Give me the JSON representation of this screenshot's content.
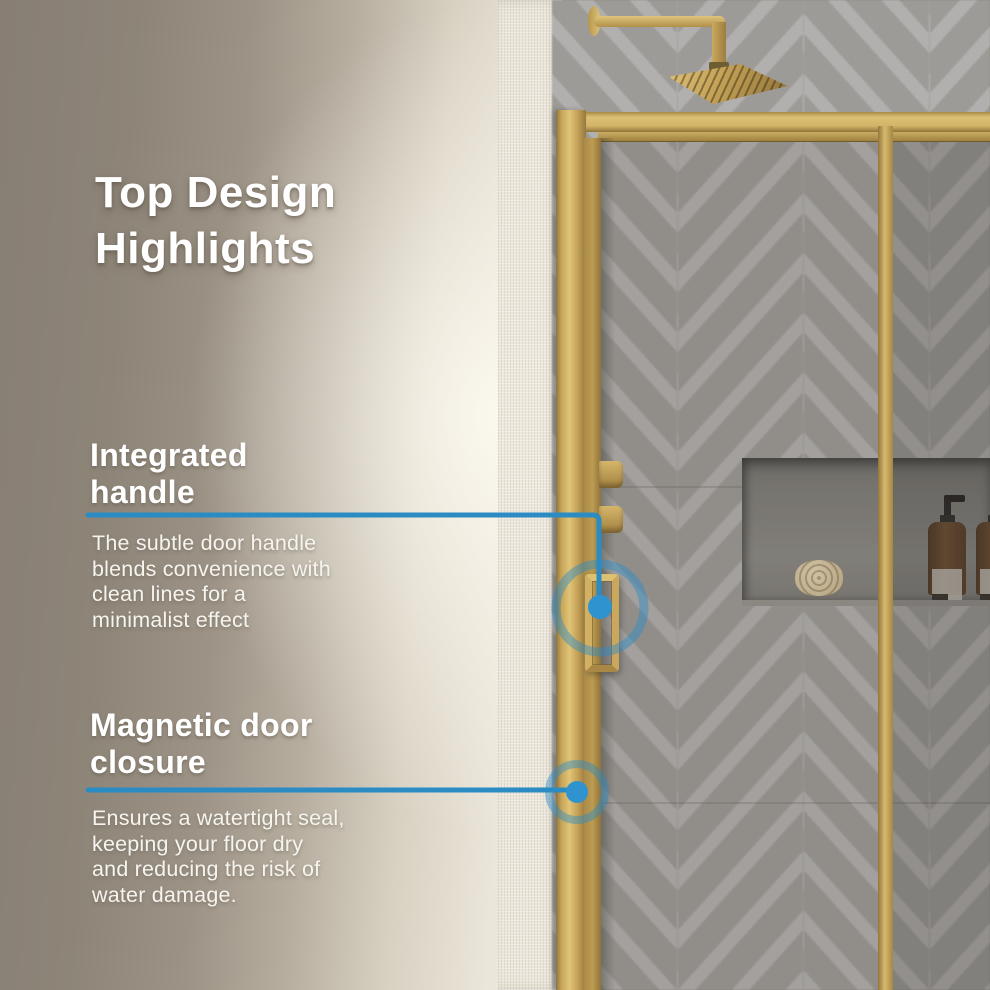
{
  "title": "Top Design\nHighlights",
  "features": [
    {
      "heading": "Integrated\nhandle",
      "body": "The subtle door handle\nblends convenience with\nclean lines for a\nminimalist effect"
    },
    {
      "heading": "Magnetic door\nclosure",
      "body": "Ensures a watertight seal,\nkeeping your floor dry\nand reducing the risk of\nwater damage."
    }
  ],
  "colors": {
    "accent_blue": "#2b8cc4",
    "accent_blue_ring": "rgba(43,140,200,0.45)",
    "frame_gold": "#c9a75b",
    "wall_taupe": "#8a8177",
    "wall_cream": "#ece7db",
    "tile_gray": "#a3a19e"
  }
}
